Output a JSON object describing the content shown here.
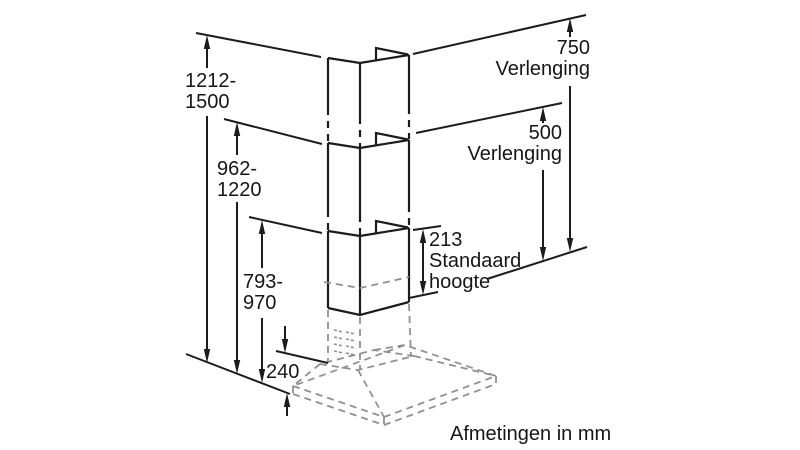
{
  "diagram": {
    "type": "dimension-drawing",
    "subject": "chimney-cooker-hood-with-extensions",
    "caption": "Afmetingen in mm",
    "colors": {
      "line": "#1c1c1c",
      "hidden_line": "#909090",
      "background": "#ffffff"
    },
    "dimensions": {
      "height_with_750": {
        "lines": [
          "1212-",
          "1500"
        ]
      },
      "height_with_500": {
        "lines": [
          "962-",
          "1220"
        ]
      },
      "height_standard": {
        "lines": [
          "793-",
          "970"
        ]
      },
      "canopy_height": {
        "value": "240"
      },
      "extension_750": {
        "value": "750",
        "label": "Verlenging"
      },
      "extension_500": {
        "value": "500",
        "label": "Verlenging"
      },
      "chimney_standard": {
        "value": "213",
        "label_lines": [
          "Standaard",
          "hoogte"
        ]
      }
    }
  }
}
